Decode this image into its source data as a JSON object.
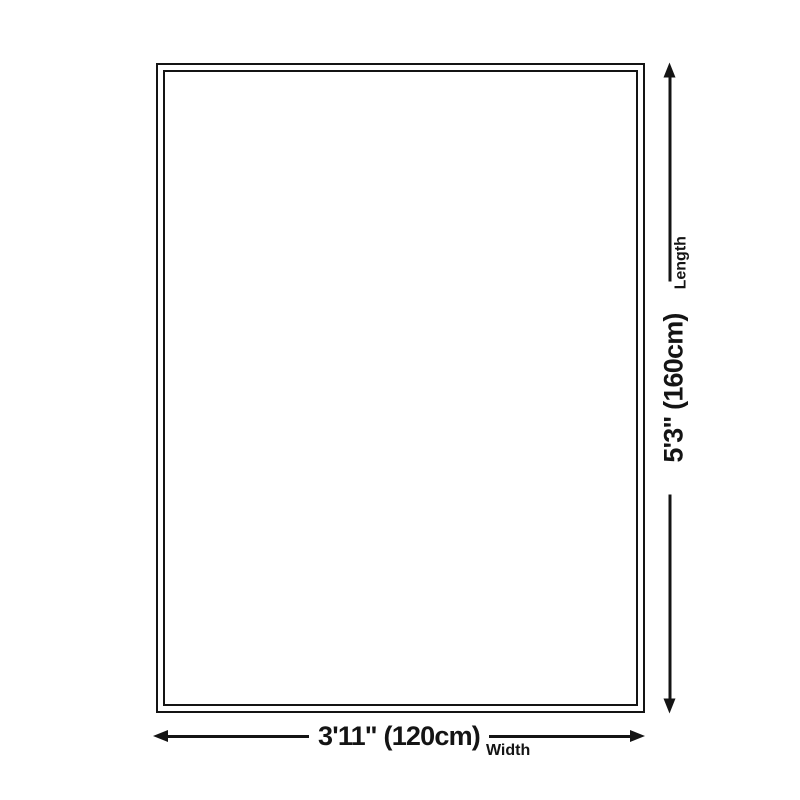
{
  "diagram": {
    "kind": "product-size-diagram",
    "background": "#ffffff",
    "ink_color": "#141414",
    "rug": {
      "shape": "rectangle",
      "border_style": "double-line"
    },
    "width_dim": {
      "value": "3'11\" (120cm)",
      "label": "Width",
      "arrow": "double-headed-horizontal"
    },
    "length_dim": {
      "value": "5'3\" (160cm)",
      "label": "Length",
      "arrow": "double-headed-vertical"
    }
  }
}
